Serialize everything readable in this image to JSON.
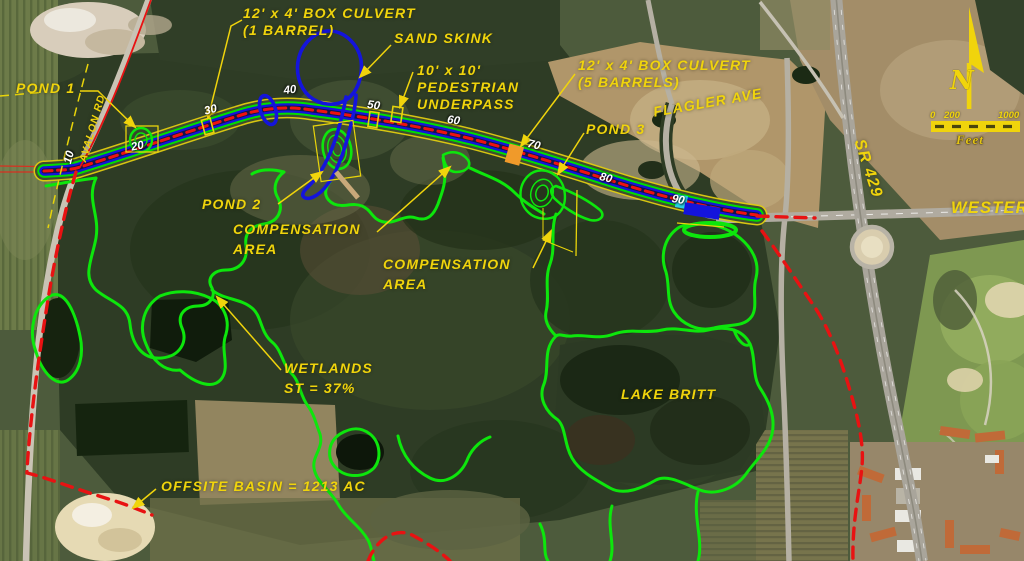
{
  "annotations": {
    "box_culvert_1_line1": "12' x 4' BOX CULVERT",
    "box_culvert_1_line2": "(1 BARREL)",
    "sand_skink": "SAND SKINK",
    "ped_underpass_line1": "10' x 10'",
    "ped_underpass_line2": "PEDESTRIAN",
    "ped_underpass_line3": "UNDERPASS",
    "box_culvert_5_line1": "12' x 4' BOX CULVERT",
    "box_culvert_5_line2": "(5 BARRELS)",
    "pond_1": "POND 1",
    "pond_2": "POND 2",
    "pond_3": "POND 3",
    "comp_area_1_line1": "COMPENSATION",
    "comp_area_1_line2": "AREA",
    "comp_area_2_line1": "COMPENSATION",
    "comp_area_2_line2": "AREA",
    "wetlands_line1": "WETLANDS",
    "wetlands_line2": "ST = 37%",
    "lake_britt": "LAKE BRITT",
    "offsite_basin": "OFFSITE BASIN = 1213 AC"
  },
  "roads": {
    "avalon": "AVALON RD",
    "flagler": "FLAGLER AVE",
    "sr_429": "SR 429",
    "western": "WESTERN"
  },
  "stations": [
    "10",
    "20",
    "30",
    "40",
    "50",
    "60",
    "70",
    "80",
    "90"
  ],
  "compass": {
    "north": "N"
  },
  "scale_bar": {
    "tick_0": "0",
    "tick_200": "200",
    "tick_1000": "1000",
    "unit": "Feet"
  },
  "legend_colors": {
    "annotation_text": "#f0d40c",
    "wetland_outline": "#0de60c",
    "sand_skink_outline": "#1414dc",
    "project_boundary": "#e81212",
    "roadway_edge": "#00dd00",
    "roadway_inner": "#1414dc",
    "roadway_centerline": "#ee1111",
    "station_text": "#ffffff"
  }
}
